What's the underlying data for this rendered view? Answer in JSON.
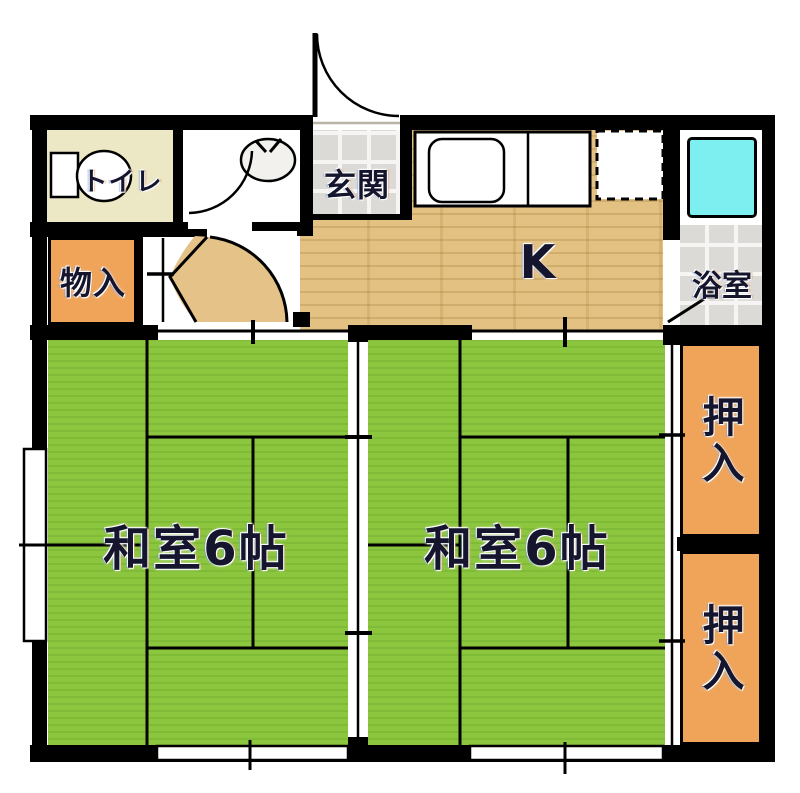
{
  "plan_type": "apartment-floor-plan",
  "rooms": {
    "toilet": {
      "label": "トイレ"
    },
    "entrance": {
      "label": "玄関"
    },
    "kitchen": {
      "label": "K"
    },
    "bathroom": {
      "label": "浴室"
    },
    "storage": {
      "label": "物入"
    },
    "tatami_left": {
      "label": "和室6帖"
    },
    "tatami_right": {
      "label": "和室6帖"
    },
    "closet_upper": {
      "label": "押入"
    },
    "closet_lower": {
      "label": "押入"
    }
  },
  "fixtures": [
    "entrance-door",
    "toilet-bowl",
    "toilet-tank",
    "washbasin",
    "kitchen-sink",
    "kitchen-counter",
    "refrigerator-space",
    "bathtub",
    "bifold-door",
    "sliding-doors",
    "windows"
  ],
  "colors": {
    "tatami_green": "#8cc63e",
    "closet_orange": "#efa45a",
    "kitchen_wood": "#e1be7b",
    "toilet_cream": "#ece7c5",
    "tile_gray": "#dcdad6",
    "bathtub_cyan": "#7deff0",
    "wall_black": "#000000"
  }
}
